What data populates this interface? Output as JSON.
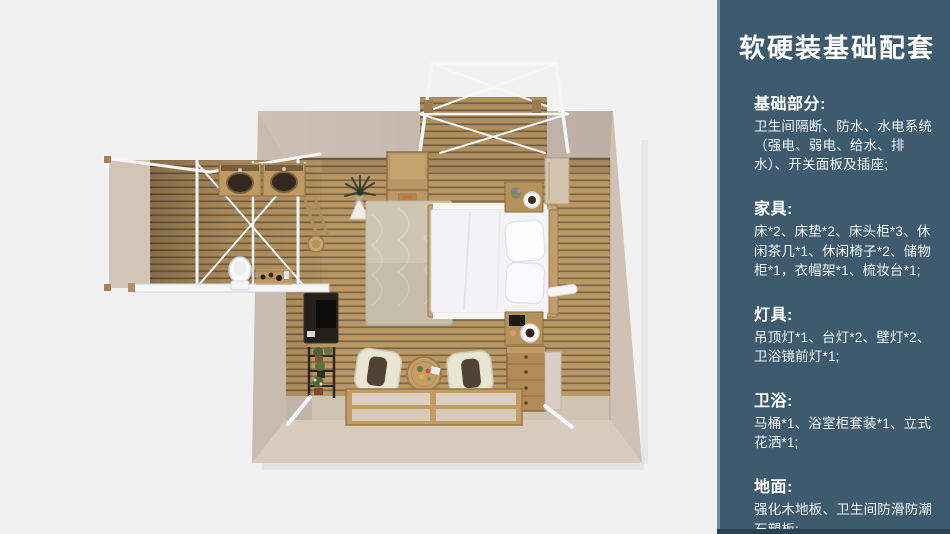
{
  "slide": {
    "type": "furnishing-package-slide",
    "render_caption": "top-down 3d render of cabin suite: bedroom, bathroom wing, canopy decks"
  },
  "sidebar": {
    "title": "软硬装基础配套",
    "sections": [
      {
        "heading": "基础部分:",
        "body": "卫生间隔断、防水、水电系统（强电、弱电、给水、排水）、开关面板及插座;"
      },
      {
        "heading": "家具:",
        "body": "床*2、床垫*2、床头柜*3、休闲茶几*1、休闲椅子*2、储物柜*1，衣帽架*1、梳妆台*1;"
      },
      {
        "heading": "灯具:",
        "body": "吊顶灯*1、台灯*2、壁灯*2、卫浴镜前灯*1;"
      },
      {
        "heading": "卫浴:",
        "body": "马桶*1、浴室柜套装*1、立式花洒*1;"
      },
      {
        "heading": "地面:",
        "body": "强化木地板、卫生间防滑防潮石塑板;"
      }
    ]
  },
  "palette": {
    "page_bg": "#f1f1f2",
    "sidebar_bg": "#3d5a6e",
    "sidebar_edge": "#74899a",
    "sidebar_bottom": "#2b4151",
    "wall_top": "#c8bcb1",
    "wall_right": "#cfc2b5",
    "wall_bottom": "#d8cbbe",
    "wall_left": "#c9bcaf",
    "floor_wood": "#bd9760",
    "floor_wood_dark": "#7c6748",
    "floor_wood_mid": "#a5906e",
    "floor_beige": "#cfc3b4",
    "deck_canvas": "#d2c4b6",
    "frame_white": "#f6f6f8",
    "bed_white": "#f3f3f6",
    "wood_furniture": "#b69259",
    "cushion_dark": "#504234"
  }
}
